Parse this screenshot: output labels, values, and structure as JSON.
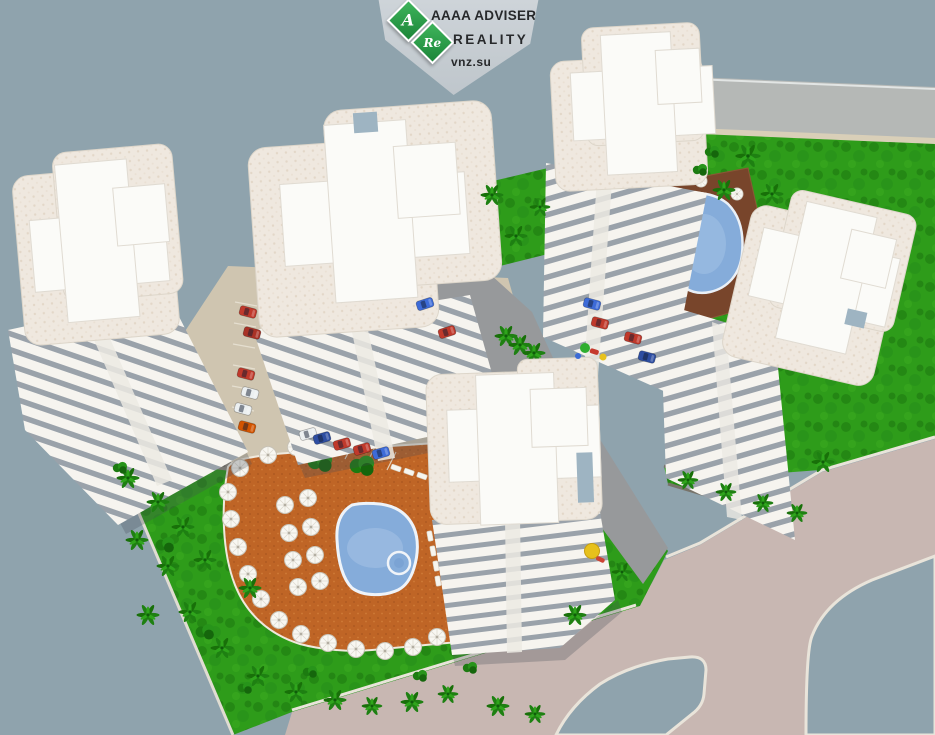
{
  "watermark": {
    "badge_a": "A",
    "badge_re": "Re",
    "line1": "AAAA ADVISER",
    "line2": "REALITY",
    "line3": "vnz.su"
  },
  "scene": {
    "type": "aerial-3d-architectural-render",
    "description": "Bird's-eye 3D visualization of a residential complex: five white high-rise towers with cross-shaped rooftops, a large free-form swimming pool on an orange sun deck with white umbrellas and loungers, a second smaller pool on a brown deck, green lawns with palm trees, parking areas with cars, a children's playground, and light-colored roads bordering the site",
    "building_count": 5,
    "pool_count": 2
  },
  "colors": {
    "ground": "#8fa3ad",
    "road": "#c8b7b2",
    "road_top": "#b5b8b6",
    "curb": "#e9e4da",
    "lawn": "#2e9c1a",
    "deck_orange": "#bf6526",
    "deck_brown": "#78452b",
    "pool_blue": "#85acda",
    "roof_slab": "#efe8df",
    "roof_cross": "#fbfbf8",
    "stripe_gap": "#9aa2aa",
    "stripe_bar": "#f6f4ef",
    "paving": "#cfc5b0",
    "driveway": "#97999b",
    "wall": "#8f8b80",
    "badge_bg": "#c7ced3",
    "badge_green": "#2f9e4b",
    "badge_text": "#27292b"
  }
}
